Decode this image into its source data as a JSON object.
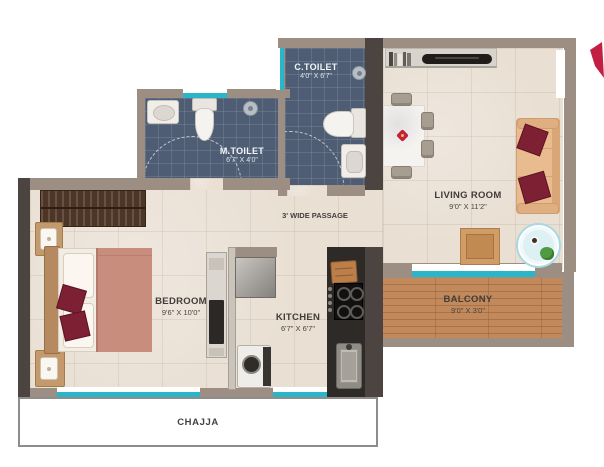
{
  "plan": {
    "title": "apartment-floor-plan",
    "rooms": {
      "c_toilet": {
        "label": "C.TOILET",
        "dims": "4'0\" X 6'7\""
      },
      "m_toilet": {
        "label": "M.TOILET",
        "dims": "6'7\" X 4'0\""
      },
      "living_room": {
        "label": "LIVING ROOM",
        "dims": "9'0\" X 11'2\""
      },
      "bedroom": {
        "label": "BEDROOM",
        "dims": "9'6\" X 10'0\""
      },
      "kitchen": {
        "label": "KITCHEN",
        "dims": "6'7\" X 6'7\""
      },
      "balcony": {
        "label": "BALCONY",
        "dims": "9'0\" X 3'0\""
      },
      "passage": {
        "label": "3' WIDE PASSAGE"
      },
      "chajja": {
        "label": "CHAJJA"
      }
    },
    "colors": {
      "wall": "#9c8e82",
      "wall_dark": "#4b4440",
      "floor": "#e9dfd3",
      "toilet_floor": "#4e5d73",
      "balcony_floor": "#c28a5c",
      "window_glass": "#2ab5c9",
      "cushion_maroon": "#7d2033",
      "duvet_salmon": "#c98d7e",
      "sofa_tan": "#e9bc8f",
      "logo_red": "#c21f45"
    },
    "furniture": {
      "bedroom": [
        "wardrobe",
        "bed",
        "pillows",
        "cushions",
        "nightstand-with-lamp",
        "dresser-with-tv"
      ],
      "living_room": [
        "tv-console",
        "tv",
        "dining-table",
        "dining-chairs",
        "sofa",
        "cushions",
        "coffee-table",
        "round-glass-table",
        "plant",
        "coffee-cup"
      ],
      "kitchen": [
        "fridge",
        "washing-machine",
        "counter",
        "cutting-board",
        "gas-stove",
        "sink"
      ],
      "m_toilet": [
        "wash-basin",
        "wc",
        "shower",
        "door-swing"
      ],
      "c_toilet": [
        "shower",
        "wc",
        "wash-basin",
        "door-swing"
      ]
    }
  }
}
